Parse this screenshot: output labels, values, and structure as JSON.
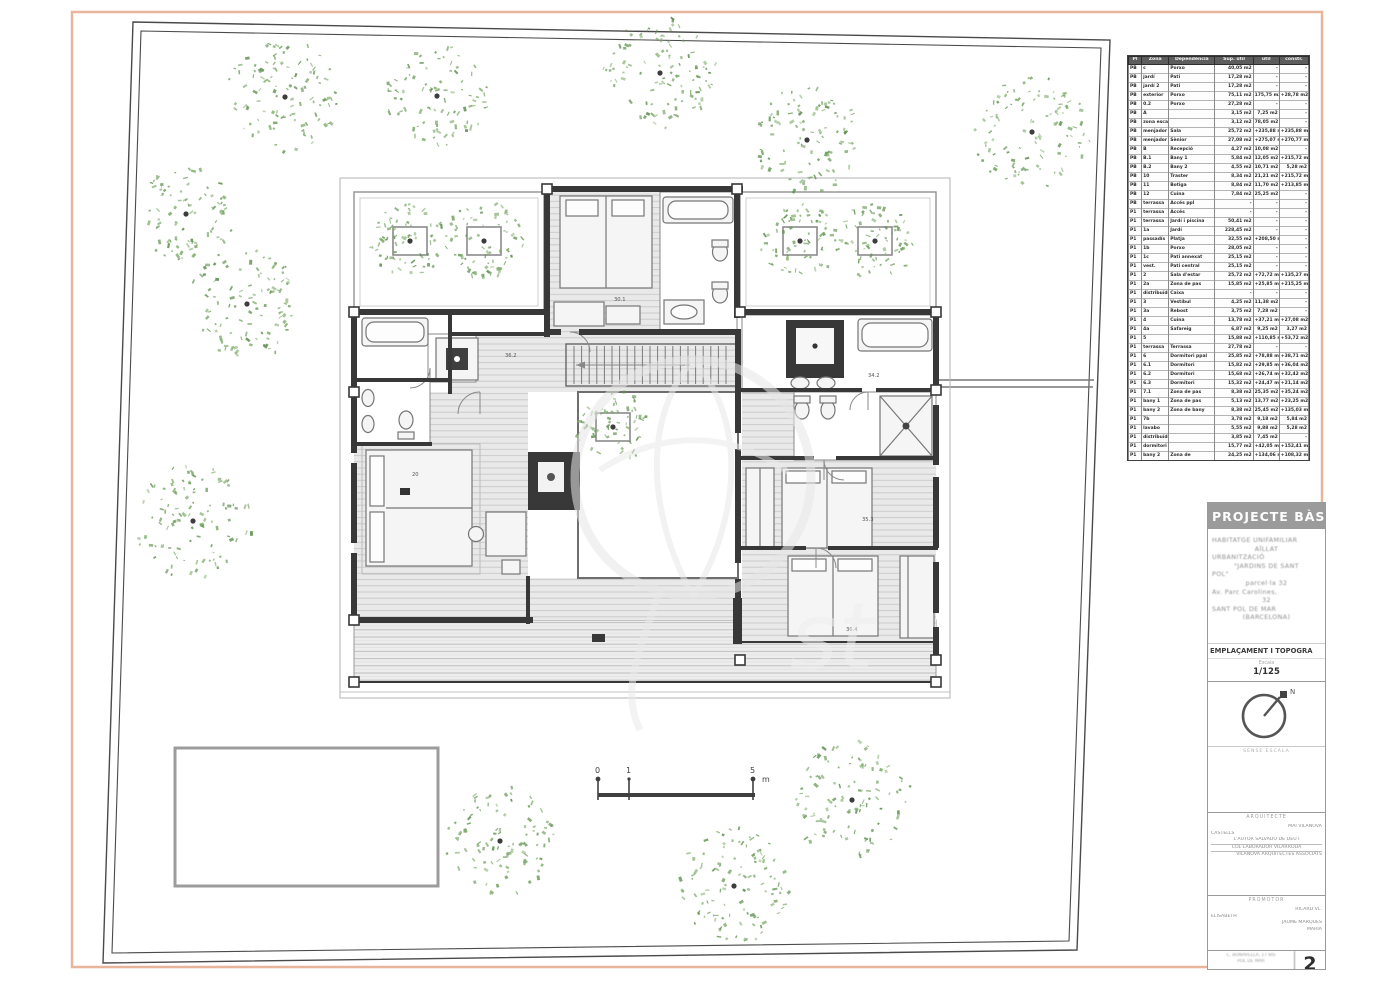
{
  "colors": {
    "frame_orange": "#e8b59c",
    "boundary": "#4a4a4a",
    "wall_dark": "#383838",
    "hatch_line": "#c8c8c8",
    "room_fill": "#e9e9e9",
    "tree_greens": [
      "#6f9e5d",
      "#7fae6b",
      "#5e8f4e"
    ],
    "pool_stroke": "#9c9c9c",
    "watermark": "#e7e7e7"
  },
  "area_table": {
    "columns": [
      "Pl",
      "Zona",
      "Dependència",
      "Sup. útil",
      "útil",
      "constr."
    ],
    "rows": [
      [
        "PB",
        "c",
        "Porxo",
        "40,05 m2",
        "-",
        "-"
      ],
      [
        "PB",
        "jardí",
        "Pati",
        "17,28 m2",
        "-",
        "-"
      ],
      [
        "PB",
        "jardí 2",
        "Pati",
        "17,28 m2",
        "-",
        "-"
      ],
      [
        "PB",
        "exterior",
        "Porxo",
        "75,11 m2",
        "175,75 m2",
        "+28,78 m2"
      ],
      [
        "PB",
        "0.2",
        "Porxo",
        "27,28 m2",
        "-",
        "-"
      ],
      [
        "PB",
        "A",
        "",
        "3,15 m2",
        "7,25 m2",
        "-"
      ],
      [
        "PB",
        "zona escala",
        "",
        "3,12 m2",
        "78,05 m2",
        "-"
      ],
      [
        "PB",
        "menjador",
        "Sala",
        "25,72 m2",
        "+235,88 m2",
        "+235,88 m2"
      ],
      [
        "PB",
        "menjador 1",
        "Sènior",
        "27,08 m2",
        "+275,07 m2",
        "+270,77 m2"
      ],
      [
        "PB",
        "B",
        "Recepció",
        "4,27 m2",
        "10,08 m2",
        "-"
      ],
      [
        "PB",
        "B.1",
        "Bany 1",
        "5,84 m2",
        "12,05 m2",
        "+215,72 m2"
      ],
      [
        "PB",
        "B.2",
        "Bany 2",
        "4,55 m2",
        "10,71 m2",
        "5,28 m2"
      ],
      [
        "PB",
        "10",
        "Traster",
        "8,34 m2",
        "21,21 m2",
        "+215,72 m2"
      ],
      [
        "PB",
        "11",
        "Botiga",
        "8,84 m2",
        "11,70 m2",
        "+213,85 m2"
      ],
      [
        "PB",
        "12",
        "Cuina",
        "7,84 m2",
        "25,25 m2",
        "-"
      ],
      [
        "PB",
        "terrassa",
        "Accés ppl",
        "-",
        "-",
        "-"
      ],
      [
        "P1",
        "terrassa",
        "Accés",
        "-",
        "-",
        "-"
      ],
      [
        "P1",
        "terrassa",
        "Jardí i piscina",
        "50,41 m2",
        "-",
        "-"
      ],
      [
        "P1",
        "1a",
        "Jardí",
        "228,45 m2",
        "-",
        "-"
      ],
      [
        "P1",
        "passadís",
        "Platja",
        "32,55 m2",
        "+208,50 m2",
        "-"
      ],
      [
        "P1",
        "1b",
        "Porxo",
        "28,05 m2",
        "-",
        "-"
      ],
      [
        "P1",
        "1c",
        "Pati annexat",
        "25,15 m2",
        "-",
        "-"
      ],
      [
        "P1",
        "vest.",
        "Pati central",
        "25,15 m2",
        "-",
        "-"
      ],
      [
        "P1",
        "2",
        "Sala d'estar",
        "25,72 m2",
        "+72,72 m2",
        "+135,27 m2"
      ],
      [
        "P1",
        "2a",
        "Zona de pas",
        "15,85 m2",
        "+25,85 m2",
        "+215,25 m2"
      ],
      [
        "P1",
        "distribuïdor",
        "Caixa",
        "-",
        "-",
        "-"
      ],
      [
        "P1",
        "3",
        "Vestíbul",
        "4,25 m2",
        "11,38 m2",
        "-"
      ],
      [
        "P1",
        "3a",
        "Rebost",
        "3,75 m2",
        "7,28 m2",
        "-"
      ],
      [
        "P1",
        "4",
        "Cuina",
        "13,78 m2",
        "+37,21 m2",
        "+27,08 m2"
      ],
      [
        "P1",
        "4a",
        "Safareig",
        "6,87 m2",
        "9,25 m2",
        "3,27 m2"
      ],
      [
        "P1",
        "5",
        "",
        "15,88 m2",
        "+110,85 m2",
        "+53,72 m2"
      ],
      [
        "P1",
        "terrassa",
        "Terrassa",
        "27,78 m2",
        "-",
        "-"
      ],
      [
        "P1",
        "6",
        "Dormitori ppal",
        "25,85 m2",
        "+78,88 m2",
        "+38,71 m2"
      ],
      [
        "P1",
        "6.1",
        "Dormitori",
        "15,82 m2",
        "+29,85 m2",
        "+36,04 m2"
      ],
      [
        "P1",
        "6.2",
        "Dormitori",
        "15,68 m2",
        "+26,74 m2",
        "+32,42 m2"
      ],
      [
        "P1",
        "6.3",
        "Dormitori",
        "15,32 m2",
        "+24,47 m2",
        "+21,14 m2"
      ],
      [
        "P1",
        "7.1",
        "Zona de pas",
        "8,38 m2",
        "25,35 m2",
        "+35,24 m2"
      ],
      [
        "P1",
        "bany 1",
        "Zona de pas",
        "5,13 m2",
        "13,77 m2",
        "+23,25 m2"
      ],
      [
        "P1",
        "bany 2",
        "Zona de bany",
        "8,38 m2",
        "25,45 m2",
        "+135,03 m2"
      ],
      [
        "P1",
        "7b",
        "",
        "3,78 m2",
        "9,18 m2",
        "5,84 m2"
      ],
      [
        "P1",
        "lavabo",
        "",
        "5,55 m2",
        "9,88 m2",
        "5,28 m2"
      ],
      [
        "P1",
        "distribuïdor 1",
        "",
        "3,85 m2",
        "7,45 m2",
        "-"
      ],
      [
        "P1",
        "dormitori jove",
        "",
        "15,77 m2",
        "+42,05 m2",
        "+152,41 m2"
      ],
      [
        "P1",
        "bany 2",
        "Zona de",
        "24,25 m2",
        "+134,06 m2",
        "+108,32 m2"
      ]
    ]
  },
  "plan": {
    "labels": [
      {
        "x": 614,
        "y": 301,
        "t": "30.1"
      },
      {
        "x": 505,
        "y": 357,
        "t": "36.2"
      },
      {
        "x": 868,
        "y": 377,
        "t": "34.2"
      },
      {
        "x": 412,
        "y": 476,
        "t": "20"
      },
      {
        "x": 862,
        "y": 521,
        "t": "35.3"
      },
      {
        "x": 846,
        "y": 631,
        "t": "36.4"
      }
    ],
    "garden_trees": [
      [
        285,
        97,
        57
      ],
      [
        437,
        96,
        50
      ],
      [
        660,
        73,
        55
      ],
      [
        807,
        140,
        52
      ],
      [
        1032,
        132,
        56
      ],
      [
        186,
        214,
        46
      ],
      [
        247,
        304,
        56
      ],
      [
        193,
        521,
        57
      ],
      [
        500,
        841,
        54
      ],
      [
        734,
        886,
        58
      ],
      [
        852,
        800,
        58
      ]
    ],
    "planter_trees": [
      [
        410,
        241,
        38
      ],
      [
        484,
        241,
        38
      ],
      [
        800,
        241,
        38
      ],
      [
        875,
        241,
        38
      ],
      [
        613,
        427,
        36
      ]
    ]
  },
  "scale_bar": {
    "ticks": [
      "0",
      "1",
      "5"
    ],
    "unit": "m"
  },
  "title_block": {
    "header": "PROJECTE BÀS",
    "project_lines": [
      "HABITATGE UNIFAMILIAR",
      "AÏLLAT",
      "URBANITZACIÓ",
      "\"JARDINS DE SANT",
      "POL\"",
      "parcel·la 32",
      "Av. Parc Carolines,",
      "32",
      "SANT POL DE MAR",
      "(BARCELONA)"
    ],
    "drawing_title": "EMPLAÇAMENT I TOPOGRA",
    "scale_label": "Escala",
    "scale_value": "1/125",
    "north_label": "N",
    "compass_caption": "SENSE ESCALA",
    "architect_label": "ARQUITECTE",
    "architect_lines": [
      "MAI VILANOVA",
      "CASTELLS",
      "L'AUTOR SALVADÓ DE DEU I",
      "COL·LABORADOR VILARRODÀ",
      "VILANOVA ARQUITECTES ASSOCIATS"
    ],
    "promoter_label": "PROMOTOR",
    "promoter_lines": [
      "RICARD VL.",
      "ELISABETH",
      "JAUME MARQUÈS",
      "MARIA"
    ],
    "footer_lines": [
      "C. BONAVELLA, 17 BIS",
      "POL DE MAR"
    ],
    "sheet_number": "2"
  }
}
